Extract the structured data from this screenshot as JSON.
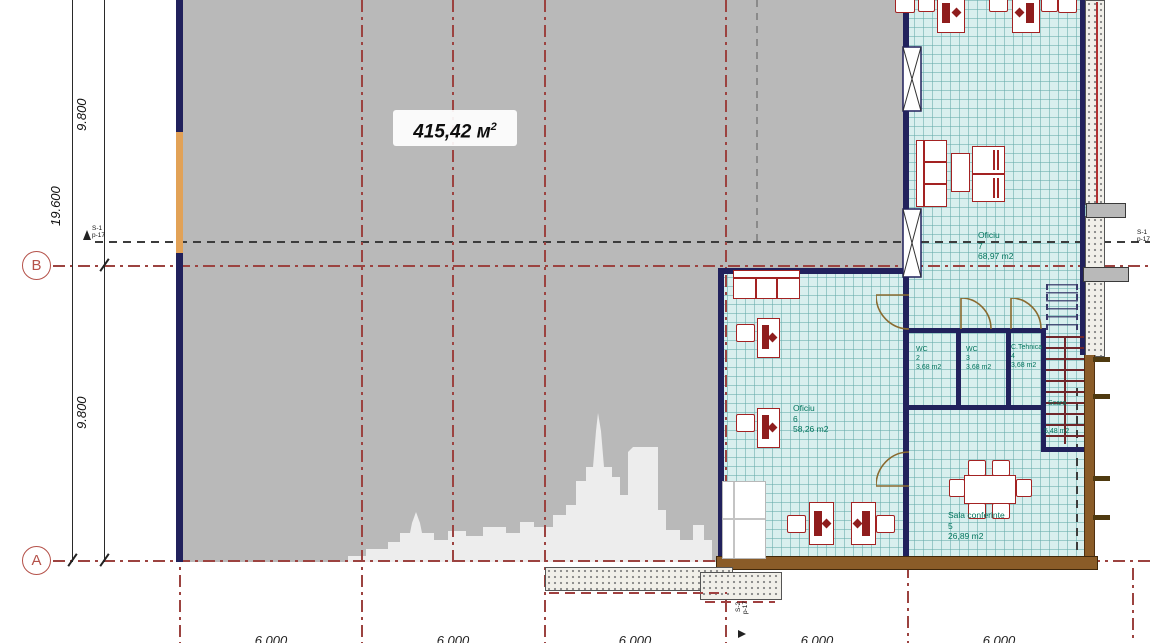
{
  "watermark": {
    "area_value": "415,42 м",
    "area_sup": "2"
  },
  "rooms": {
    "oficiu7": {
      "name": "Oficiu",
      "number": "7",
      "area": "68,97 m2"
    },
    "oficiu6": {
      "name": "Oficiu",
      "number": "6",
      "area": "58,26 m2"
    },
    "wc2": {
      "name": "WC",
      "number": "2",
      "area": "3,68 m2"
    },
    "wc3": {
      "name": "WC",
      "number": "3",
      "area": "3,68 m2"
    },
    "c_tehnica": {
      "name": "C.Tehnica",
      "number": "4",
      "area": "3,68 m2"
    },
    "scara": {
      "name": "Scara",
      "area": "5,48 m2"
    },
    "sala_conferinte": {
      "name": "Sala conferinte",
      "number": "5",
      "area": "26,89 m2"
    }
  },
  "dimensions": {
    "left_total": "19.600",
    "left_upper": "9.800",
    "left_lower": "9.800",
    "bottom": [
      "6.000",
      "6.000",
      "6.000",
      "6.000",
      "6.000"
    ]
  },
  "axis_markers": {
    "b": "B",
    "a": "A"
  },
  "section_markers": {
    "left": {
      "line1": "S-1",
      "line2": "p-17"
    },
    "right": {
      "line1": "S-1",
      "line2": "p-17"
    },
    "bottom": {
      "line1": "S-2",
      "line2": "p-17"
    }
  },
  "colors": {
    "unfinished_gray": "#b9b9b9",
    "floor_cyan": "#d8efee",
    "wall_navy": "#21215c",
    "furniture_red": "#a32222",
    "label_green": "#00745c",
    "axis_red": "#9c4340",
    "timber_brown": "#8a5c28",
    "accent_orange": "#e2a257"
  }
}
